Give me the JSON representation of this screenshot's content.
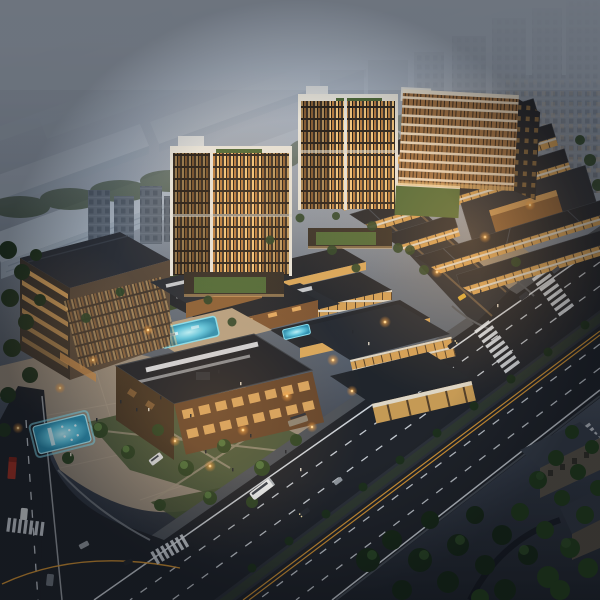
{
  "meta": {
    "type": "architectural-aerial-rendering",
    "time_of_day": "dusk",
    "description": "Aerial dusk rendering of a mixed-use development: two mid-rise towers with amber-lit facades and green roof terraces, a terraced apartment block, a low-rise retail village with dark folded roofs, large commercial blocks with rooftop pool courtyards, a lit public plaza with a glowing cyan pool, a tree-lined arterial road with crosswalks and vehicles, hazy industrial warehouses and high-rise slabs in the background"
  },
  "palette": {
    "haze": "#b0bac8",
    "sky_top": "#a6b0be",
    "ground_dark": "#20252d",
    "warehouse_roof": "#9fabb9",
    "warehouse_side": "#8896a6",
    "bg_tower_slab": "#6d7886",
    "bg_tower_window": "#46505f",
    "road": "#20242b",
    "road_marking_white": "#dfe5ec",
    "road_marking_orange": "#dd9a35",
    "roof_dark": "#23272e",
    "trim_white": "#e6e4dc",
    "facade_warm": "#d8a75c",
    "window_amber": "#f0c27c",
    "green_roof": "#4e6a3a",
    "lawn": "#46553a",
    "tree_dark": "#1d301d",
    "tree_light": "#4c6a3a",
    "paving": "#94897b",
    "pool_cyan": "#35b0d4",
    "pool_glow": "#86dff2",
    "lamp_glow": "#ffd794",
    "bus_white": "#e9edf0",
    "truck_red": "#a33226",
    "taxi_yellow": "#d9ab3a"
  },
  "scene": {
    "background": {
      "industrial_district": "rows of hazy blue-grey warehouses, upper left",
      "residential_highrises": "hazy window-grid slabs, upper right"
    },
    "buildings": [
      {
        "name": "office-tower-west",
        "floors_lit": true,
        "roof": "green terraces"
      },
      {
        "name": "office-tower-east",
        "floors_lit": true,
        "roof": "green terraces"
      },
      {
        "name": "terraced-apartment-building",
        "style": "stepped cream slabs, amber windows, green podium"
      },
      {
        "name": "left-office-building",
        "style": "dark hipped roof, amber window bands"
      },
      {
        "name": "retail-village",
        "style": "dark folded roofs over warm lit walls"
      },
      {
        "name": "commercial-blocks",
        "style": "charcoal roofs, white skylight strips, timber facades"
      },
      {
        "name": "corner-residential-blocks",
        "style": "dark, unlit, among trees"
      }
    ],
    "water_features": [
      {
        "name": "plaza-pool",
        "glow": true
      },
      {
        "name": "rooftop-courtyard-pool",
        "glow": true
      },
      {
        "name": "terrace-pool",
        "glow": true
      }
    ],
    "roads": {
      "arterial": "tree-median boulevard running to lower left",
      "side_street": "lit lane through the retail village",
      "left_road": "vertical street at lower left",
      "markings": [
        "white dashed lanes",
        "double orange centerline",
        "zebra crosswalks"
      ]
    },
    "vehicles": [
      {
        "name": "city-bus",
        "color_key": "bus_white"
      },
      {
        "name": "minibus",
        "color_key": "bus_white"
      },
      {
        "name": "red-truck",
        "color_key": "truck_red"
      },
      {
        "name": "taxi",
        "color_key": "taxi_yellow"
      },
      {
        "name": "cars",
        "count": 9
      }
    ],
    "street_lights": 15,
    "pedestrians": "small figures across the plaza and retail corner"
  }
}
